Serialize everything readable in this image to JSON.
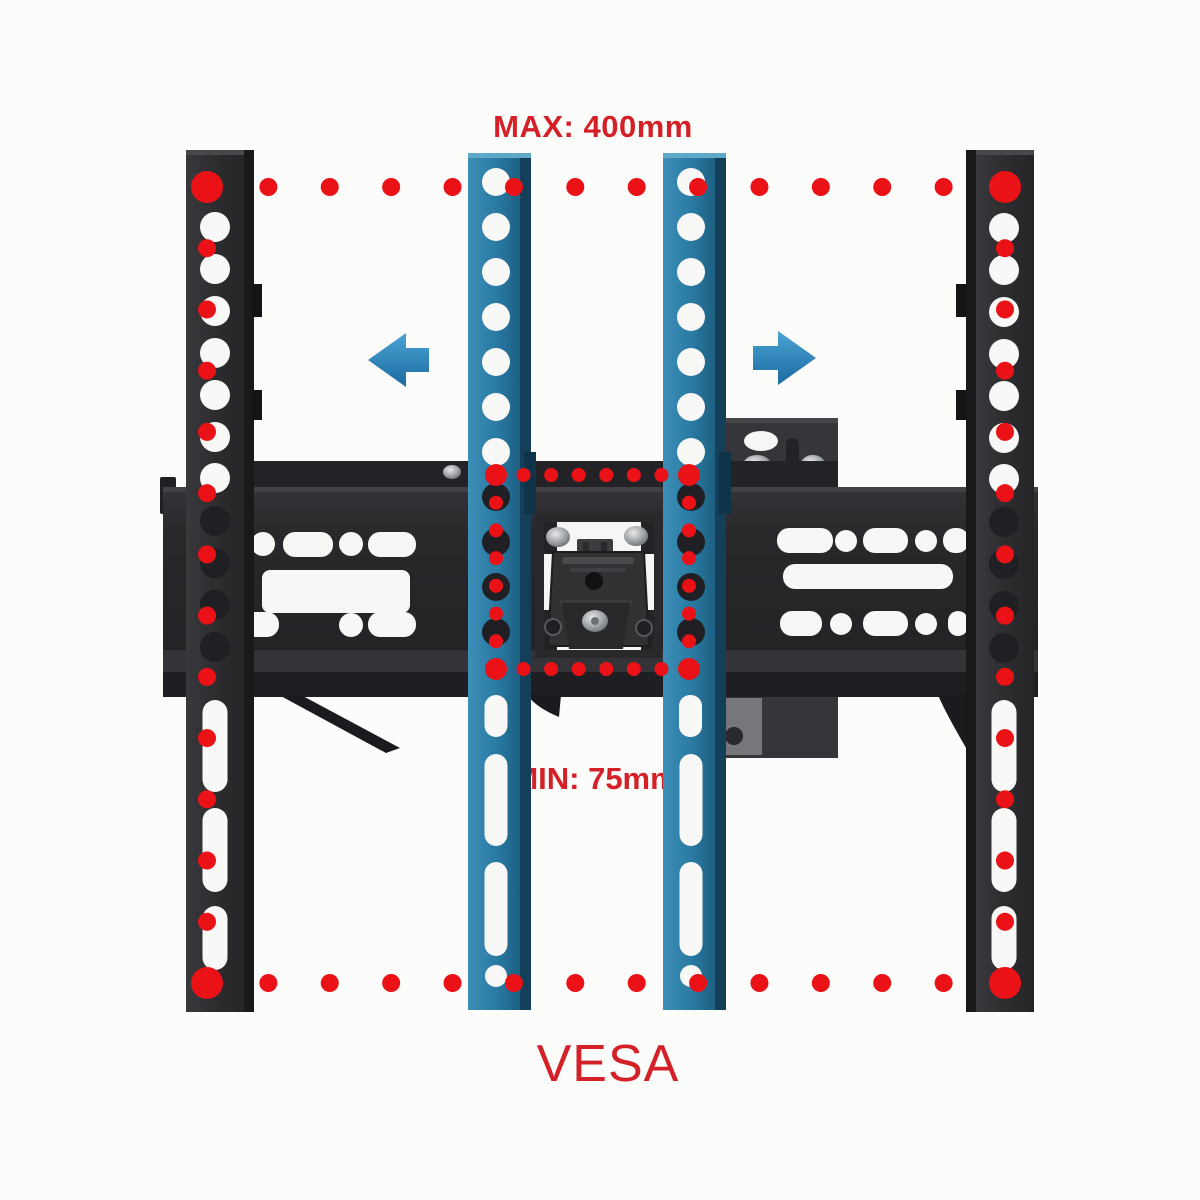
{
  "labels": {
    "max": "MAX: 400mm",
    "min": "MIN: 75mm",
    "vesa": "VESA"
  },
  "colors": {
    "background": "#fcfcfb",
    "dot_red": "#ea1117",
    "text_red": "#d42127",
    "hole_light": "#f8f8f7",
    "hole_dark": "#202024",
    "bracket_black": "#2d2d30",
    "bracket_blue": "#2a7aa3",
    "arrow_blue": "#2483bb"
  },
  "vesa_pattern": {
    "outer": {
      "label": "MAX: 400mm",
      "dimension_mm": 400,
      "x1": 207,
      "y1": 187,
      "x2": 1005,
      "y2": 983,
      "edge_dot_count": 12,
      "corner_dot_radius": 16,
      "edge_dot_radius": 9
    },
    "inner": {
      "label": "MIN: 75mm",
      "dimension_mm": 75,
      "x1": 496,
      "y1": 475,
      "x2": 689,
      "y2": 669,
      "edge_dot_count": 6,
      "corner_dot_radius": 11,
      "edge_dot_radius": 7
    }
  },
  "arrows": [
    {
      "name": "arrow-left",
      "direction": "left"
    },
    {
      "name": "arrow-right",
      "direction": "right"
    }
  ],
  "brackets": [
    {
      "id": "holes-black-left",
      "cx": 215,
      "r": 15,
      "light_holes_y": [
        227,
        269,
        311,
        353,
        395,
        437,
        478
      ],
      "dark_holes_y": [
        521,
        563,
        605,
        647
      ],
      "slot_width": 25,
      "slots_y": [
        [
          700,
          792
        ],
        [
          808,
          892
        ],
        [
          906,
          970
        ]
      ],
      "extra_hole_y": null
    },
    {
      "id": "holes-black-right",
      "cx": 1004,
      "r": 15,
      "light_holes_y": [
        228,
        270,
        312,
        354,
        396,
        438,
        479
      ],
      "dark_holes_y": [
        522,
        564,
        606,
        648
      ],
      "slot_width": 25,
      "slots_y": [
        [
          700,
          792
        ],
        [
          808,
          892
        ],
        [
          906,
          970
        ]
      ],
      "extra_hole_y": null
    },
    {
      "id": "holes-blue-left",
      "cx": 496,
      "r": 14,
      "light_holes_y": [
        182,
        227,
        272,
        317,
        362,
        407,
        452
      ],
      "dark_holes_y": [
        497,
        542,
        587,
        632
      ],
      "slot_width": 23,
      "slots_y": [
        [
          695,
          737
        ],
        [
          754,
          846
        ],
        [
          862,
          956
        ]
      ],
      "extra_hole_y": 976
    },
    {
      "id": "holes-blue-right",
      "cx": 691,
      "r": 14,
      "light_holes_y": [
        182,
        227,
        272,
        317,
        362,
        407,
        452
      ],
      "dark_holes_y": [
        497,
        542,
        587,
        632
      ],
      "slot_width": 23,
      "slots_y": [
        [
          754,
          846
        ],
        [
          862,
          956
        ]
      ],
      "extra_hole_y": 976
    }
  ]
}
